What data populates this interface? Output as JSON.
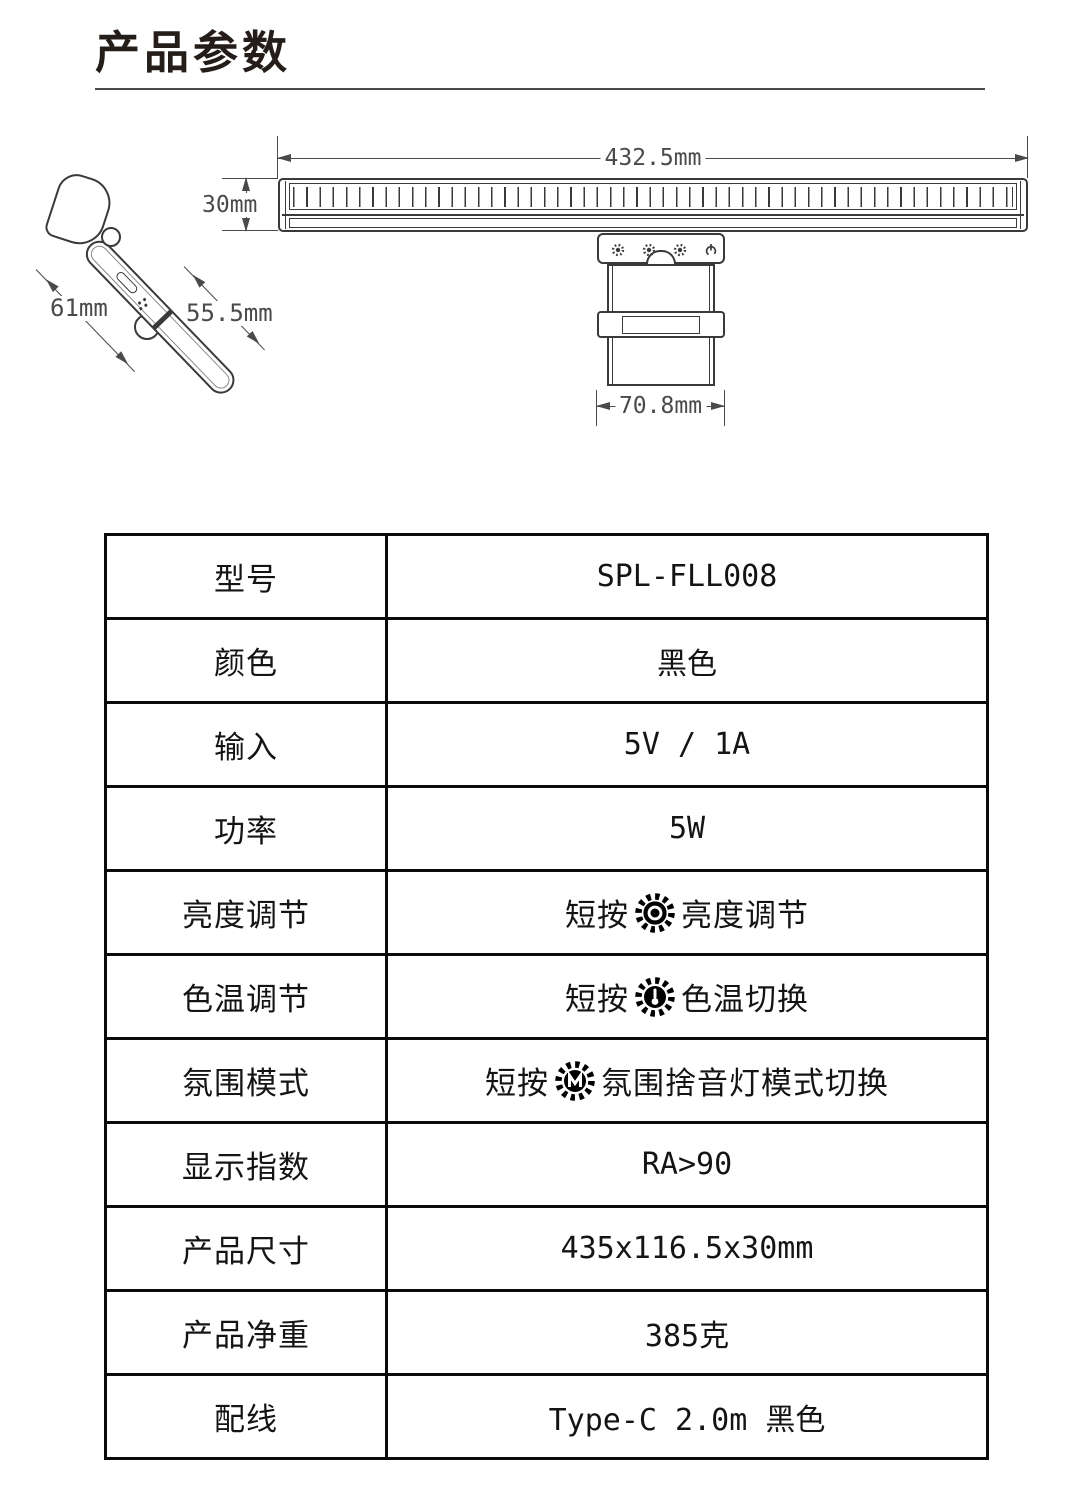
{
  "page": {
    "title": "产品参数"
  },
  "drawing": {
    "front_view_width": "432.5mm",
    "front_view_height": "30mm",
    "side_head_length": "61mm",
    "side_arm_length": "55.5mm",
    "bracket_width": "70.8mm",
    "plate_icons": [
      "sun-button",
      "sun-button",
      "sun-button",
      "power-button"
    ]
  },
  "icons": {
    "brightness": "sun-with-dot",
    "color_temp": "sun-with-thermometer",
    "ambient": "sun-with-letter-m"
  },
  "table": {
    "rows": [
      {
        "label": "型号",
        "value": "SPL-FLL008"
      },
      {
        "label": "颜色",
        "value": "黑色"
      },
      {
        "label": "输入",
        "value": "5V / 1A"
      },
      {
        "label": "功率",
        "value": "5W"
      },
      {
        "label": "亮度调节",
        "prefix": "短按",
        "suffix": "亮度调节"
      },
      {
        "label": "色温调节",
        "prefix": "短按",
        "suffix": "色温切换"
      },
      {
        "label": "氛围模式",
        "prefix": "短按",
        "suffix": "氛围捨音灯模式切换"
      },
      {
        "label": "显示指数",
        "value": "RA>90"
      },
      {
        "label": "产品尺寸",
        "value": "435x116.5x30mm"
      },
      {
        "label": "产品净重",
        "value": "385克"
      },
      {
        "label": "配线",
        "value": "Type-C 2.0m 黑色"
      }
    ]
  }
}
